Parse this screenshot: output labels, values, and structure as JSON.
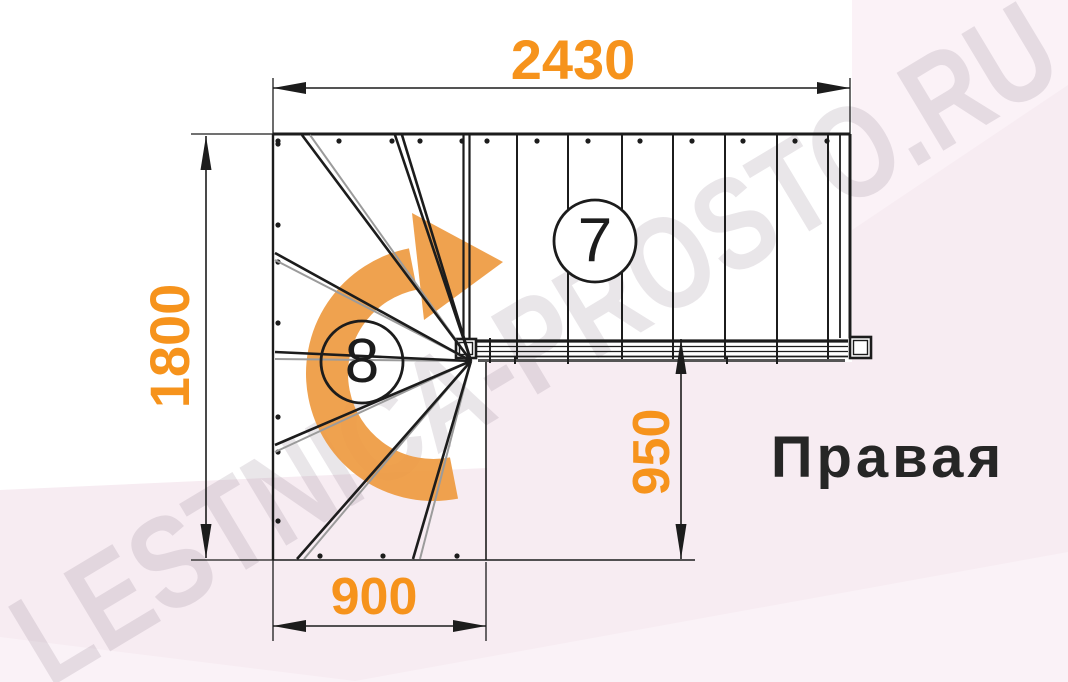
{
  "page": {
    "bg_base": "#F7ECF2",
    "bg_white": "#FFFFFF",
    "bg_light_wedge": "#FAF2F7",
    "bg_topright": "#FBF2F7"
  },
  "watermark": {
    "text": "LESTNICA-PROSTO.RU",
    "color": "rgba(125,108,125,0.17)"
  },
  "labels": {
    "orientation": "Правая",
    "steps_upper_flight": "7",
    "steps_winder": "8"
  },
  "dimensions": {
    "top_width": "2430",
    "left_height": "1800",
    "exit_width": "950",
    "bottom_width": "900"
  },
  "colors": {
    "dimension_text": "#F6931C",
    "arrow_orange": "#EE9A40",
    "line": "#1C1C1C",
    "gray": "#9B9B9B",
    "shadow": "#555555"
  },
  "drawing": {
    "outline": [
      [
        273,
        134,
        850,
        134,
        3
      ],
      [
        273,
        134,
        273,
        560,
        2.4
      ],
      [
        850,
        134,
        850,
        338,
        3
      ],
      [
        840,
        135,
        840,
        338,
        1.8
      ],
      [
        273,
        560,
        695,
        560,
        1.6
      ],
      [
        486,
        362,
        486,
        560,
        1.6
      ]
    ],
    "treads": {
      "xs": [
        517,
        568,
        622,
        673,
        725,
        777,
        828
      ],
      "y1": 135,
      "y2": 360,
      "w": 2
    },
    "first_tread_pair": [
      [
        463.5,
        135,
        463.5,
        340,
        2.2
      ],
      [
        469.5,
        135,
        469.5,
        340,
        2.2
      ]
    ],
    "fan": {
      "origin": [
        471,
        361
      ],
      "black": [
        [
          302,
          135
        ],
        [
          395,
          135
        ],
        [
          402,
          135
        ],
        [
          275,
          253
        ],
        [
          275,
          352
        ],
        [
          275,
          445
        ],
        [
          297,
          559
        ],
        [
          413,
          559
        ]
      ],
      "gray": [
        [
          310,
          135
        ],
        [
          275,
          260
        ],
        [
          275,
          359
        ],
        [
          275,
          452
        ],
        [
          304,
          559
        ],
        [
          420,
          559
        ]
      ]
    },
    "stringer": {
      "lines": [
        [
          476,
          341,
          848,
          341,
          3.2
        ],
        [
          476,
          346.5,
          848,
          346.5,
          1.3
        ],
        [
          476,
          351.5,
          848,
          351.5,
          1.3
        ],
        [
          476,
          356.5,
          848,
          356.5,
          1.8
        ]
      ],
      "shadow": [
        478,
        360.5,
        845,
        360.5,
        3
      ],
      "joints": [
        [
          490,
          338,
          363
        ],
        [
          515,
          357,
          364
        ],
        [
          568,
          357,
          364
        ],
        [
          727,
          357,
          364
        ],
        [
          777,
          357,
          364
        ]
      ]
    },
    "posts": [
      [
        456,
        339,
        20,
        19
      ],
      [
        850,
        337,
        21,
        21
      ]
    ],
    "circles": [
      {
        "cx": 595,
        "cy": 241,
        "r": 41
      },
      {
        "cx": 362,
        "cy": 362,
        "r": 41
      }
    ],
    "rotation_arrow": {
      "band": "M 454 478 A 102 102 0 1 1 413 269",
      "band_width": 42,
      "head": "412,213 424,320 503,262"
    },
    "dots": {
      "top": {
        "y": 141,
        "xs": [
          278,
          339,
          392,
          420,
          462,
          487,
          537,
          588,
          640,
          692,
          743,
          795,
          827
        ]
      },
      "left": {
        "x": 278,
        "ys": [
          144,
          225,
          262,
          323,
          417,
          452,
          521
        ]
      },
      "bottom": {
        "y": 556,
        "xs": [
          320,
          383,
          457
        ]
      }
    },
    "dims": {
      "lines": [
        [
          273,
          88,
          850,
          88
        ],
        [
          206,
          136,
          206,
          558
        ],
        [
          681,
          339,
          681,
          559
        ],
        [
          273,
          626,
          486,
          626
        ]
      ],
      "ext": [
        [
          273,
          78,
          273,
          134
        ],
        [
          850,
          78,
          850,
          134
        ],
        [
          191,
          134,
          273,
          134
        ],
        [
          191,
          560,
          273,
          560
        ],
        [
          273,
          560,
          273,
          641
        ],
        [
          486,
          562,
          486,
          641
        ]
      ],
      "arrows": [
        "273,88 306,82 306,94",
        "850,88 817,82 817,94",
        "206,136 200.5,170 211.5,170",
        "206,558 200.5,524 211.5,524",
        "681,339 675.5,374 686.5,374",
        "681,559 675.5,524 686.5,524",
        "273,626 306,620 306,632",
        "486,626 453,620 453,632"
      ]
    }
  }
}
